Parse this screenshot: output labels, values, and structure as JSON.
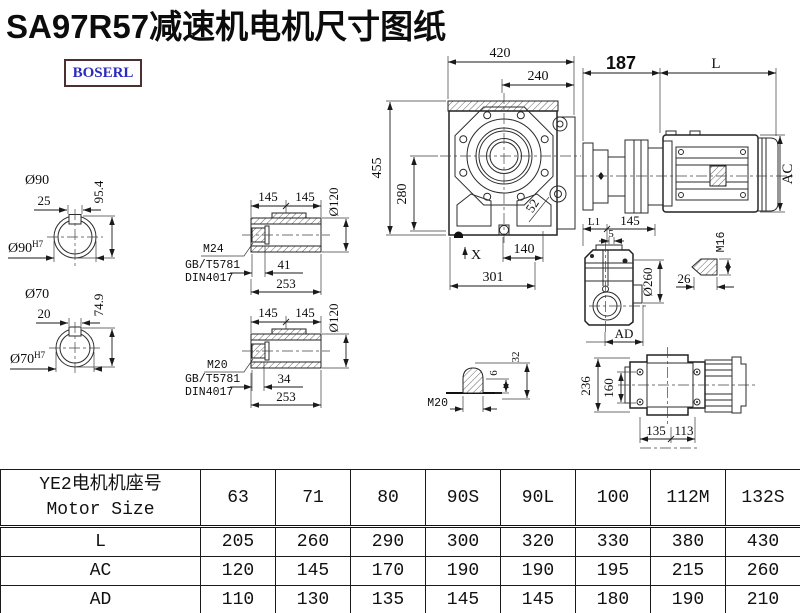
{
  "title": "SA97R57减速机电机尺寸图纸",
  "logo": {
    "text": "BOSERL"
  },
  "drawing": {
    "fv": {
      "w420": "420",
      "w240": "240",
      "h455": "455",
      "h280": "280",
      "a52": "52",
      "b140": "140",
      "b301": "301",
      "x": "X"
    },
    "mv": {
      "a187": "187",
      "L": "L",
      "AC": "AC"
    },
    "sa": {
      "dia": "Ø90",
      "key": "25",
      "h": "95.4",
      "bore": "Ø90",
      "fit": "H7"
    },
    "sb": {
      "dia": "Ø70",
      "key": "20",
      "h": "74.9",
      "bore": "Ø70",
      "fit": "H7"
    },
    "ha": {
      "s1": "145",
      "s2": "145",
      "dia": "Ø120",
      "bolt": "M24",
      "std1": "GB/T5781",
      "std2": "DIN4017",
      "len": "41",
      "total": "253"
    },
    "hb": {
      "s1": "145",
      "s2": "145",
      "dia": "Ø120",
      "bolt": "M20",
      "std1": "GB/T5781",
      "std2": "DIN4017",
      "len": "34",
      "total": "253"
    },
    "sv": {
      "L1": "L1",
      "w145": "145",
      "w5": "5",
      "dia": "Ø260",
      "AD": "AD"
    },
    "m16": {
      "label": "M16",
      "len": "26"
    },
    "m20": {
      "label": "M20",
      "h6": "6",
      "h32": "32"
    },
    "rv": {
      "h236": "236",
      "h160": "160",
      "w135": "135",
      "w113": "113"
    }
  },
  "table": {
    "header_cn": "YE2电机机座号",
    "header_en": "Motor Size",
    "sizes": [
      "63",
      "71",
      "80",
      "90S",
      "90L",
      "100",
      "112M",
      "132S"
    ],
    "rows": [
      {
        "label": "L",
        "values": [
          "205",
          "260",
          "290",
          "300",
          "320",
          "330",
          "380",
          "430"
        ]
      },
      {
        "label": "AC",
        "values": [
          "120",
          "145",
          "170",
          "190",
          "190",
          "195",
          "215",
          "260"
        ]
      },
      {
        "label": "AD",
        "values": [
          "110",
          "130",
          "135",
          "145",
          "145",
          "180",
          "190",
          "210"
        ]
      }
    ]
  }
}
